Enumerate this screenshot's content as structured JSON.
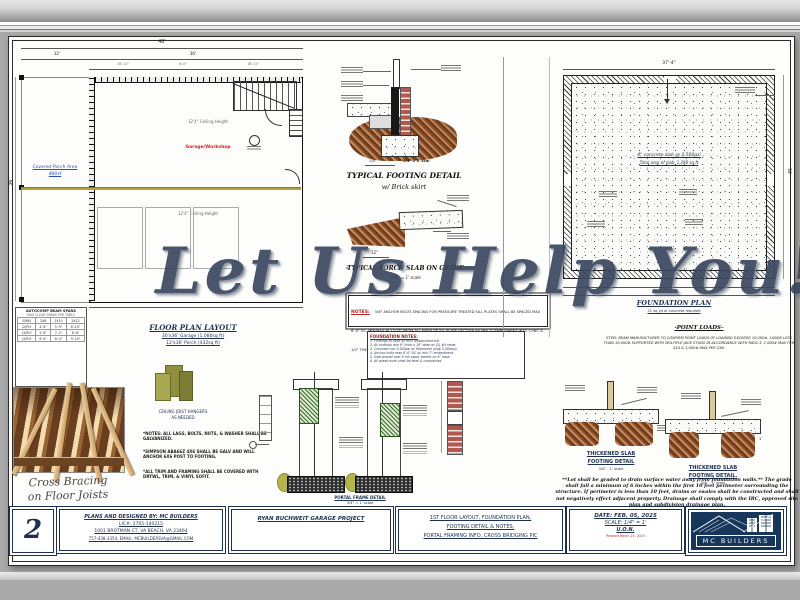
{
  "watermark": "Let Us Help You!",
  "sheet": {
    "floor_plan": {
      "title": "FLOOR PLAN LAYOUT",
      "sub1": "30'x36' Garage (1,080sq ft)",
      "sub2": "12'x36' Porch (432sq ft)",
      "room": "Garage/Workshop",
      "porch1": "Covered Porch Area",
      "porch2": "480sf",
      "ceiling_a": "12'4\" Ceiling Height",
      "ceiling_b": "12'4\" Ceiling Height",
      "dims": {
        "overall": "48'",
        "left": "12'",
        "right": "36'",
        "d1": "16'-11\"",
        "d2": "6'-0\"",
        "d3": "16'-11\"",
        "side": "36'"
      }
    },
    "beam_table": {
      "title": "AUTOCOMP BEAM SPANS",
      "note": "MAX CLEAR SPANS PER TABLE",
      "headers": [
        "SPAN",
        "2X8",
        "2X10",
        "2X12"
      ],
      "rows": [
        [
          "(2)PLY",
          "4'-6\"",
          "5'-9\"",
          "6'-10\""
        ],
        [
          "(3)PLY",
          "5'-8\"",
          "7'-2\"",
          "8'-6\""
        ],
        [
          "(4)PLY",
          "6'-6\"",
          "8'-4\"",
          "9'-10\""
        ]
      ]
    },
    "hanger": {
      "caption1": "CEILING JOIST HANGERS",
      "caption2": "AS NEEDED"
    },
    "side_notes": [
      "*NOTES: ALL LAGS, BOLTS, NUTS, & WASHER SHALL BE GALVANIZED.",
      "*SIMPSON ABA66Z 4X6 SHALL BE GALV AND WILL ANCHOR 6X6 POST TO FOOTING.",
      "*ALL TRIM AND FRAMING SHALL BE COVERED WITH DRYWL, TRIM, & VINYL SOFIT."
    ],
    "photo_caption1": "Cross Bracing",
    "photo_caption2": "on Floor Joists",
    "footing_detail": {
      "title": "TYPICAL FOOTING DETAIL",
      "subtitle": "w/ Brick skirt",
      "scale_left": "1/4\"",
      "scale": "3/4\" = 1' scal"
    },
    "porch_slab": {
      "title": "-TYPICAL PORCH SLAB ON GRADE-",
      "scale": "3/4\" = 1' scale",
      "dim": "12\""
    },
    "notes_box": {
      "label": "NOTES:",
      "text": "5/8\" ANCHOR BOLTS SPACING FOR PRESSURE TREATED SILL PLATES SHALL BE SPACED MAX 6'-0\" OC, MIN/MAX IN 12\"/7\" FROM ALL ENDS OF EA. PLATE SECTION W/ MIN 7\" EMBEDMENT INTO CONC & 1/2\" THK WASHERS."
    },
    "foundation_notes": {
      "title": "FOUNDATION NOTES:",
      "items": [
        "1. Footings to bear on firm undisturbed soil.",
        "2. All footings min 8\" thick x 16\" wide w/ (2) #4 rebar.",
        "3. Concrete min 3,000psi w/ fibermesh (slab 3,500psi).",
        "4. Anchor bolts max 6'-0\" OC w/ min 7\" embedment.",
        "5. Slab placed over 6 mil vapor barrier on 4\" base.",
        "6. All grade work shall be level & compacted."
      ]
    },
    "portal": {
      "caption1": "PORTAL FRAME DETAIL",
      "caption2": "3/4\" = 1' scale"
    },
    "foundation_plan": {
      "title": "FOUNDATION PLAN",
      "subtitle": "21 sq yd of concrete required",
      "slab_line1": "4\" concrete slab @ 3,500psi",
      "slab_line2": "Total area of slab: 1,296 sq ft",
      "dim_top": "37'-4\"",
      "dim_right": "38'"
    },
    "point_loads": {
      "title": "-POINT LOADS-",
      "text": "STEEL BEAM MANUFACTURER TO CONFIRM POINT LOADS OF LOADING EXCEEDS 10,000#. LOADS LESS THAN 10,000# SUPPORTED WITH MULTIPLE JACK STUDS IN ACCORDANCE WITH R602.3. 2,000# MAX PER 2X4 & 3,000# MAX PER 2X6."
    },
    "thick_slab_a": {
      "t1": "THICKENED SLAB",
      "t2": "FOOTING DETAIL",
      "scale": "3/4\" - 1' scale"
    },
    "thick_slab_b": {
      "t1": "THICKENED SLAB",
      "t2": "FOOTING DETAIL.",
      "scale": "3/4\" - 1' scale"
    },
    "grading_note": "**Lot shall be graded to drain surface water away from foundation walls.** The grade shall fall a minimum of 6 inches within the first 10 feet perimeter surrounding the structure. If perimeter is less than 10 feet, drains or swales shall be constructed and shall not negatively effect adjacent property. Drainage shall comply with the IRC, approved site plan and subdivision drainage plan."
  },
  "title_block": {
    "sheet_number": "2",
    "designer_line1": "PLANS AND DESIGNED BY: MC BUILDERS",
    "designer_line2": "LIC#: 2705-140215",
    "designer_line3": "1001 BROTMAN CT, VA BEACH, VA 23464",
    "designer_line4": "757-438-3354, EMAIL: MCBUILDERSVA@GMAIL.COM",
    "project": "RYAN BUCHWEIT GARAGE PROJECT",
    "sheet_title_line1": "1ST FLOOR LAYOUT, FOUNDATION PLAN,",
    "sheet_title_line2": "FOOTING DETAIL & NOTES,",
    "sheet_title_line3": "PORTAL FRAMING INFO, CROSS BRIDGING PIC",
    "date": "DATE: FEB. 05, 2025",
    "scale": "SCALE: 1/4\" = 1'",
    "uon": "U.O.N.",
    "revised": "Revised March 25, 2025",
    "logo_text": "MC BUILDERS"
  },
  "colors": {
    "accent_navy": "#17365c",
    "watermark": "#39475e",
    "red_note": "#bb2222",
    "beam_yellow": "#b3a23c"
  }
}
